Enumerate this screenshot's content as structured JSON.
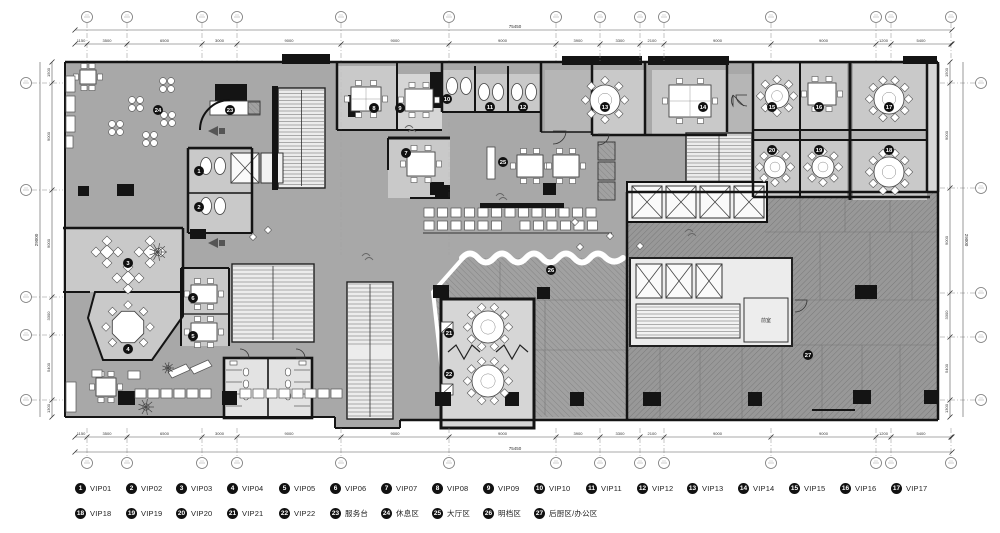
{
  "colors": {
    "slab": "#a8a8a8",
    "room": "#c9c9c9",
    "room_light": "#d6d6d6",
    "corridor": "#b6b6b6",
    "hatch_base": "#9b9b9b",
    "hatch_line": "#7d7d7d",
    "wall": "#141414",
    "dim": "#555555",
    "badge_bg": "#111111",
    "badge_fg": "#ffffff",
    "paper": "#ffffff",
    "stair": "#ececec"
  },
  "grid": {
    "top_x": [
      87,
      127,
      202,
      237,
      341,
      449,
      556,
      600,
      640,
      664,
      771,
      876,
      891,
      951
    ],
    "bottom_x": [
      87,
      127,
      202,
      237,
      341,
      449,
      556,
      600,
      640,
      664,
      771,
      876,
      891,
      951
    ],
    "left_y": [
      83,
      190,
      297,
      335,
      400
    ],
    "right_y": [
      83,
      188,
      293,
      337,
      400
    ]
  },
  "dimensions": {
    "top_total": "75450",
    "bottom_total": "75450",
    "left_total": "29000",
    "right_total": "29000",
    "top_segments": [
      "1150",
      "3500",
      "6500",
      "3000",
      "9000",
      "9000",
      "9000",
      "3900",
      "3300",
      "2100",
      "9000",
      "9000",
      "1200",
      "5400"
    ],
    "bottom_segments": [
      "1150",
      "3500",
      "6500",
      "3000",
      "9000",
      "9000",
      "9000",
      "3900",
      "3300",
      "2100",
      "9000",
      "9000",
      "1200",
      "5400"
    ],
    "left_segments": [
      "1500",
      "9000",
      "9000",
      "3300",
      "5400",
      "1300"
    ],
    "right_segments": [
      "1500",
      "9000",
      "9000",
      "3300",
      "5400",
      "1300"
    ]
  },
  "plan_labels": [
    {
      "text": "前室",
      "x": 766,
      "y": 322
    }
  ],
  "badges": [
    {
      "n": "1",
      "x": 199,
      "y": 171
    },
    {
      "n": "2",
      "x": 199,
      "y": 207
    },
    {
      "n": "3",
      "x": 128,
      "y": 263
    },
    {
      "n": "4",
      "x": 128,
      "y": 349
    },
    {
      "n": "5",
      "x": 193,
      "y": 336
    },
    {
      "n": "6",
      "x": 193,
      "y": 298
    },
    {
      "n": "7",
      "x": 406,
      "y": 153
    },
    {
      "n": "8",
      "x": 374,
      "y": 108
    },
    {
      "n": "9",
      "x": 400,
      "y": 108
    },
    {
      "n": "10",
      "x": 447,
      "y": 99
    },
    {
      "n": "11",
      "x": 490,
      "y": 107
    },
    {
      "n": "12",
      "x": 523,
      "y": 107
    },
    {
      "n": "13",
      "x": 605,
      "y": 107
    },
    {
      "n": "14",
      "x": 703,
      "y": 107
    },
    {
      "n": "15",
      "x": 772,
      "y": 107
    },
    {
      "n": "16",
      "x": 819,
      "y": 107
    },
    {
      "n": "17",
      "x": 889,
      "y": 107
    },
    {
      "n": "18",
      "x": 889,
      "y": 150
    },
    {
      "n": "19",
      "x": 819,
      "y": 150
    },
    {
      "n": "20",
      "x": 772,
      "y": 150
    },
    {
      "n": "21",
      "x": 449,
      "y": 333
    },
    {
      "n": "22",
      "x": 449,
      "y": 374
    },
    {
      "n": "23",
      "x": 230,
      "y": 110
    },
    {
      "n": "24",
      "x": 158,
      "y": 110
    },
    {
      "n": "25",
      "x": 503,
      "y": 162
    },
    {
      "n": "26",
      "x": 551,
      "y": 270
    },
    {
      "n": "27",
      "x": 808,
      "y": 355
    }
  ],
  "legend": {
    "items": [
      {
        "n": "1",
        "label": "VIP01",
        "x": 81,
        "y": 489
      },
      {
        "n": "2",
        "label": "VIP02",
        "x": 132,
        "y": 489
      },
      {
        "n": "3",
        "label": "VIP03",
        "x": 182,
        "y": 489
      },
      {
        "n": "4",
        "label": "VIP04",
        "x": 233,
        "y": 489
      },
      {
        "n": "5",
        "label": "VIP05",
        "x": 285,
        "y": 489
      },
      {
        "n": "6",
        "label": "VIP06",
        "x": 336,
        "y": 489
      },
      {
        "n": "7",
        "label": "VIP07",
        "x": 387,
        "y": 489
      },
      {
        "n": "8",
        "label": "VIP08",
        "x": 438,
        "y": 489
      },
      {
        "n": "9",
        "label": "VIP09",
        "x": 489,
        "y": 489
      },
      {
        "n": "10",
        "label": "VIP10",
        "x": 540,
        "y": 489
      },
      {
        "n": "11",
        "label": "VIP11",
        "x": 592,
        "y": 489
      },
      {
        "n": "12",
        "label": "VIP12",
        "x": 643,
        "y": 489
      },
      {
        "n": "13",
        "label": "VIP13",
        "x": 693,
        "y": 489
      },
      {
        "n": "14",
        "label": "VIP14",
        "x": 744,
        "y": 489
      },
      {
        "n": "15",
        "label": "VIP15",
        "x": 795,
        "y": 489
      },
      {
        "n": "16",
        "label": "VIP16",
        "x": 846,
        "y": 489
      },
      {
        "n": "17",
        "label": "VIP17",
        "x": 897,
        "y": 489
      },
      {
        "n": "18",
        "label": "VIP18",
        "x": 81,
        "y": 514
      },
      {
        "n": "19",
        "label": "VIP19",
        "x": 132,
        "y": 514
      },
      {
        "n": "20",
        "label": "VIP20",
        "x": 182,
        "y": 514
      },
      {
        "n": "21",
        "label": "VIP21",
        "x": 233,
        "y": 514
      },
      {
        "n": "22",
        "label": "VIP22",
        "x": 285,
        "y": 514
      },
      {
        "n": "23",
        "label": "服务台",
        "x": 336,
        "y": 514
      },
      {
        "n": "24",
        "label": "休息区",
        "x": 387,
        "y": 514
      },
      {
        "n": "25",
        "label": "大厅区",
        "x": 438,
        "y": 514
      },
      {
        "n": "26",
        "label": "明档区",
        "x": 489,
        "y": 514
      },
      {
        "n": "27",
        "label": "后厨区/办公区",
        "x": 540,
        "y": 514
      }
    ]
  }
}
